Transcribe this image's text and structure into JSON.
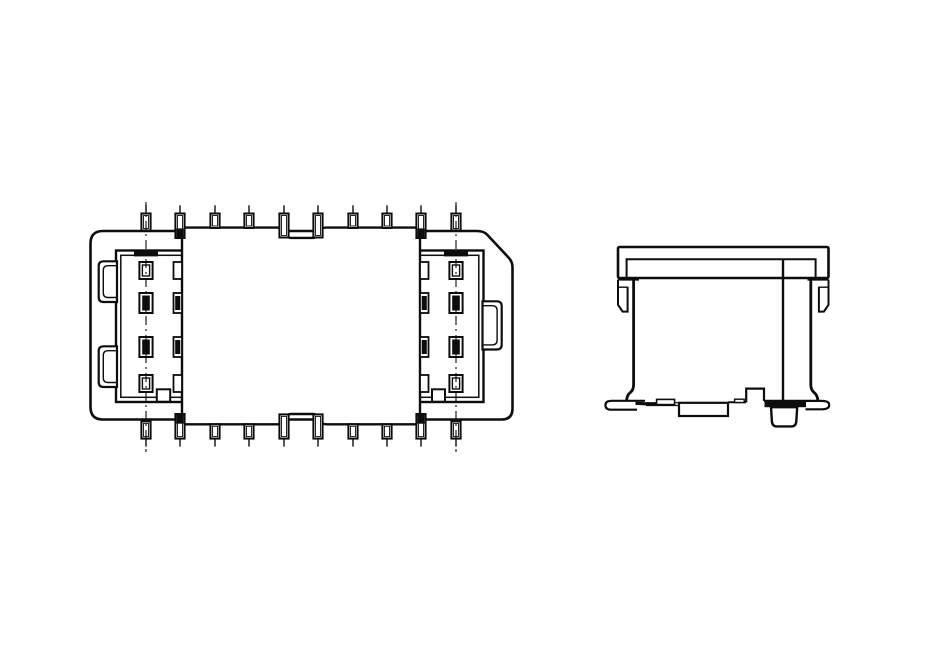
{
  "page": {
    "background": "#ffffff",
    "line_color": "#0d0d0d",
    "fill_color": "#ffffff"
  },
  "top_view": {
    "name": "connector-top-view",
    "pin_count_per_side": 10,
    "pin_x_positions": [
      146,
      180,
      215,
      249,
      284,
      318,
      353,
      387,
      421,
      456
    ],
    "pin_kinds": [
      "body",
      "edge",
      "cover",
      "cover",
      "notch",
      "notch",
      "cover",
      "cover",
      "edge",
      "body"
    ],
    "pad_columns_x": [
      146,
      456
    ],
    "pad_rows": [
      {
        "y": 262,
        "h": 17,
        "style": "hollow"
      },
      {
        "y": 293,
        "h": 20,
        "style": "filled"
      },
      {
        "y": 337,
        "h": 20,
        "style": "filled"
      },
      {
        "y": 375,
        "h": 17,
        "style": "hollow"
      }
    ],
    "edge_pad_columns_x": [
      173.5,
      420
    ],
    "centerlines_x": [
      146,
      456
    ]
  },
  "side_view": {
    "name": "connector-side-view"
  }
}
